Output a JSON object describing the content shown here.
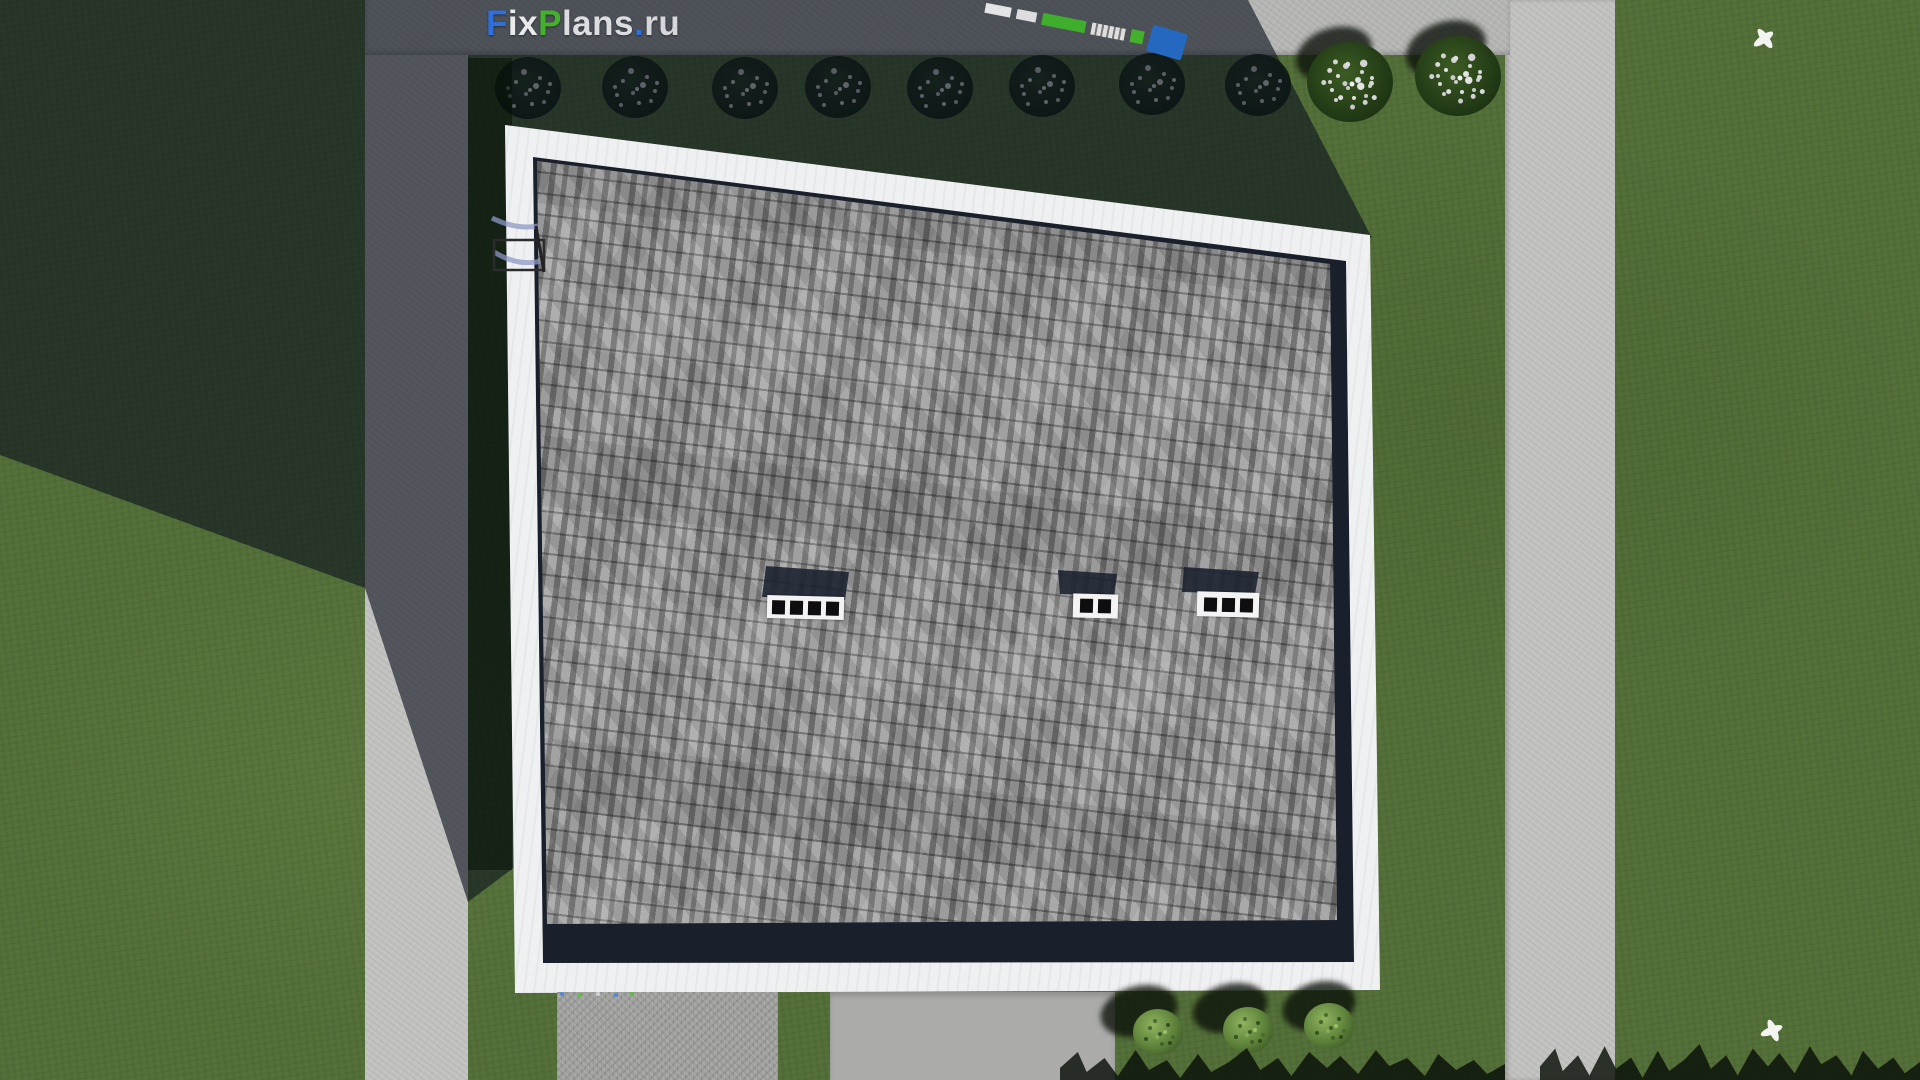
{
  "watermark": {
    "full_text": "FixPlans.ru",
    "parts": [
      {
        "text": "F",
        "color": "#2f6fdb"
      },
      {
        "text": "ix",
        "color": "#e9eaec"
      },
      {
        "text": "P",
        "color": "#43b12b"
      },
      {
        "text": "lans",
        "color": "#dcdde0"
      },
      {
        "text": ".",
        "color": "#2f6fdb"
      },
      {
        "text": "ru",
        "color": "#d6d7da"
      }
    ]
  },
  "scene": {
    "description_visible": "top-down 3D render of a house roof with yard, paths and hedge",
    "skylights": [
      {
        "panes": 4
      },
      {
        "panes": 2
      },
      {
        "panes": 3
      }
    ],
    "hedge_bushes_shaded": 8,
    "hedge_bushes_flowering": 2,
    "garden_bushes": 3,
    "birds": 2,
    "truck_segments": [
      "white",
      "white",
      "green",
      "white-striped",
      "green",
      "blue-cab"
    ],
    "palette": {
      "grass_sunlit": "#55713a",
      "grass_shadow": "#24321f",
      "concrete_sunlit": "#c2c2c0",
      "concrete_shadow": "#545b6b",
      "roof_shingle": "#9a9a9a",
      "roof_fascia": "#eff0f2",
      "eave_shadow": "#1a202b",
      "skylight_frame": "#f3f3f3",
      "truck_blue": "#2468c0",
      "truck_green": "#3fae2c"
    }
  }
}
